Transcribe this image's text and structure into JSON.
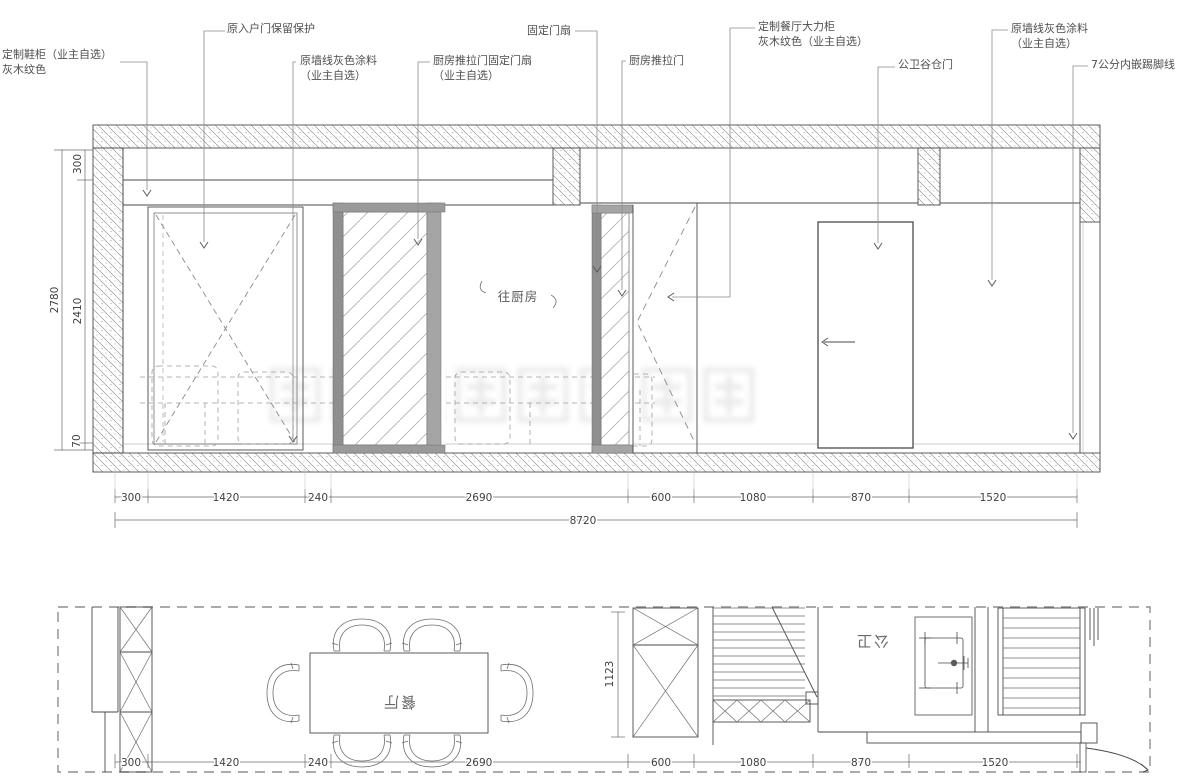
{
  "colors": {
    "line": "#4a4a4a",
    "hatch": "#9a9a9a",
    "frame_gray": "#8f8f8f",
    "dim_text": "#3f3f3f",
    "label_text": "#4f4f4f",
    "watermark": "#e0e0e0"
  },
  "elevation": {
    "callouts": [
      {
        "id": "shoe-cabinet",
        "lines": [
          "定制鞋柜（业主自选）",
          "灰木纹色"
        ]
      },
      {
        "id": "entry-door",
        "lines": [
          "原入户门保留保护"
        ]
      },
      {
        "id": "wall-paint-left",
        "lines": [
          "原墙线灰色涂料",
          "（业主自选）"
        ]
      },
      {
        "id": "kitchen-door-fixed-leaf",
        "lines": [
          "厨房推拉门固定门扇",
          "（业主自选）"
        ]
      },
      {
        "id": "fixed-door-leaf",
        "lines": [
          "固定门扇"
        ]
      },
      {
        "id": "kitchen-sliding-door",
        "lines": [
          "厨房推拉门"
        ]
      },
      {
        "id": "dining-cabinet",
        "lines": [
          "定制餐厅大力柜",
          "灰木纹色（业主自选）"
        ]
      },
      {
        "id": "bath-barn-door",
        "lines": [
          "公卫谷仓门"
        ]
      },
      {
        "id": "wall-paint-right",
        "lines": [
          "原墙线灰色涂料",
          "（业主自选）"
        ]
      },
      {
        "id": "skirting",
        "lines": [
          "7公分内嵌踢脚线"
        ]
      }
    ],
    "to_kitchen_label": "往厨房",
    "dims_bottom": [
      "300",
      "1420",
      "240",
      "2690",
      "600",
      "1080",
      "870",
      "1520"
    ],
    "dim_total": "8720",
    "dims_left": {
      "total": "2780",
      "top": "300",
      "middle": "2410",
      "bottom": "70"
    }
  },
  "plan": {
    "dining_label": "餐厅",
    "bath_label": "公卫",
    "dims_bottom": [
      "300",
      "1420",
      "240",
      "2690",
      "600",
      "1080",
      "870",
      "1520"
    ],
    "dim_vertical": "1123"
  }
}
